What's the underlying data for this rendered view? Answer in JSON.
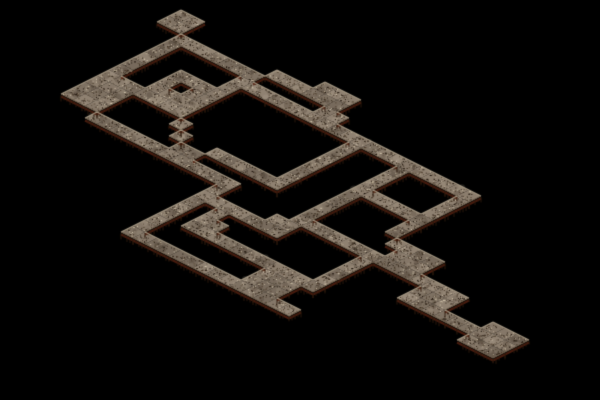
{
  "map": {
    "label": "isometric-dungeon-map",
    "background": "#000000",
    "width": 600,
    "height": 400,
    "origin": {
      "x": 133,
      "y": -26
    },
    "tile": {
      "w": 24,
      "h": 12
    },
    "palette": {
      "floor_tints": [
        "#8b7d6d",
        "#857768",
        "#8f8171",
        "#7e7162",
        "#776a5c"
      ],
      "speckle_dark": [
        "#32261a",
        "#1f150c",
        "#4a3a2a"
      ],
      "speckle_mid": "#5f5240",
      "speckle_light": [
        "#b4a68f",
        "#cfc2aa"
      ],
      "edge_highlight": "#b0a28c",
      "edge_dark": "#70604d",
      "shadow": "#54200f",
      "teeth": "#2e190c"
    },
    "features": [
      {
        "name": "north-room",
        "type": "room",
        "rect": [
          5,
          1,
          6,
          2
        ]
      },
      {
        "name": "great-ring",
        "type": "ring",
        "rect": [
          7,
          3,
          13,
          9
        ]
      },
      {
        "name": "inner-ring",
        "type": "ring",
        "rect": [
          10,
          6,
          12,
          8
        ]
      },
      {
        "name": "west-room",
        "type": "room",
        "rect": [
          7,
          10,
          9,
          12
        ]
      },
      {
        "name": "west-corridor",
        "type": "corridor",
        "rect": [
          10,
          13,
          15,
          13
        ]
      },
      {
        "name": "mid-room-a",
        "type": "room",
        "rect": [
          16,
          12,
          17,
          13
        ]
      },
      {
        "name": "ring-stair",
        "type": "cells",
        "cells": [
          [
            14,
            10
          ],
          [
            15,
            11
          ]
        ]
      },
      {
        "name": "mid-east-corridor",
        "type": "corridor",
        "rect": [
          18,
          13,
          20,
          13
        ]
      },
      {
        "name": "north-spur",
        "type": "corridor",
        "rect": [
          18,
          11,
          22,
          11
        ]
      },
      {
        "name": "annex-spur-riser",
        "type": "corridor",
        "rect": [
          23,
          5,
          23,
          11
        ]
      },
      {
        "name": "long-riser",
        "type": "corridor",
        "rect": [
          21,
          13,
          21,
          21
        ]
      },
      {
        "name": "long-south-corridor",
        "type": "corridor",
        "rect": [
          21,
          21,
          34,
          21
        ]
      },
      {
        "name": "cross-corridor",
        "type": "corridor",
        "rect": [
          22,
          15,
          25,
          15
        ]
      },
      {
        "name": "mid-room-b-door",
        "type": "cells",
        "cells": [
          [
            23,
            16
          ]
        ]
      },
      {
        "name": "mid-room-b",
        "type": "room",
        "rect": [
          23,
          17,
          24,
          18
        ]
      },
      {
        "name": "south-link",
        "type": "corridor",
        "rect": [
          25,
          18,
          29,
          18
        ]
      },
      {
        "name": "south-room",
        "type": "room",
        "rect": [
          30,
          18,
          32,
          20
        ]
      },
      {
        "name": "mid-room-c",
        "type": "room",
        "rect": [
          26,
          14,
          27,
          15
        ]
      },
      {
        "name": "gallery-drop",
        "type": "corridor",
        "rect": [
          27,
          9,
          27,
          13
        ]
      },
      {
        "name": "ring-east-upper-corridor",
        "type": "corridor",
        "rect": [
          14,
          2,
          16,
          2
        ]
      },
      {
        "name": "northeast-room",
        "type": "room",
        "rect": [
          17,
          1,
          19,
          2
        ]
      },
      {
        "name": "northeast-annex",
        "type": "room",
        "rect": [
          19,
          3,
          20,
          4
        ]
      },
      {
        "name": "annex-west-corridor",
        "type": "corridor",
        "rect": [
          14,
          4,
          18,
          4
        ]
      },
      {
        "name": "annex-east-corridor",
        "type": "corridor",
        "rect": [
          21,
          4,
          26,
          4
        ]
      },
      {
        "name": "gallery-ring",
        "type": "ring",
        "rect": [
          27,
          4,
          32,
          8
        ]
      },
      {
        "name": "gallery-south-drop",
        "type": "cells",
        "cells": [
          [
            32,
            9
          ],
          [
            32,
            10
          ],
          [
            33,
            11
          ]
        ]
      },
      {
        "name": "chain-approach",
        "type": "corridor",
        "rect": [
          28,
          13,
          33,
          13
        ]
      },
      {
        "name": "south-east-riser",
        "type": "corridor",
        "rect": [
          33,
          14,
          33,
          18
        ]
      },
      {
        "name": "chain-room-1",
        "type": "room",
        "rect": [
          34,
          11,
          36,
          13
        ]
      },
      {
        "name": "chain-bridge-1",
        "type": "cells",
        "cells": [
          [
            37,
            13
          ]
        ]
      },
      {
        "name": "chain-room-2",
        "type": "room",
        "rect": [
          38,
          13,
          40,
          15
        ]
      },
      {
        "name": "chain-bridge-2",
        "type": "corridor",
        "rect": [
          41,
          15,
          43,
          15
        ]
      },
      {
        "name": "chain-room-3",
        "type": "room",
        "rect": [
          44,
          14,
          46,
          16
        ]
      }
    ]
  }
}
